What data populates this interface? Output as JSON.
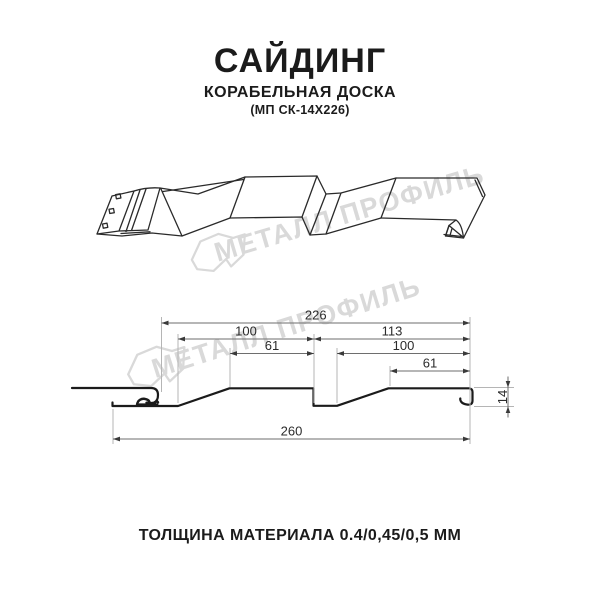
{
  "header": {
    "title": "САЙДИНГ",
    "subtitle": "КОРАБЕЛЬНАЯ ДОСКА",
    "model": "(МП СК-14Х226)"
  },
  "footer": {
    "text": "ТОЛЩИНА МАТЕРИАЛА 0.4/0,45/0,5 ММ"
  },
  "watermark": {
    "text": "МЕТАЛЛ ПРОФИЛЬ",
    "color": "#d9d9d9"
  },
  "drawing": {
    "colors": {
      "profile": "#1b1b1b",
      "sketch": "#2a2a2a",
      "dim_line": "#6e6e6e",
      "ext_line": "#b5b5b5",
      "arrow": "#3a3a3a",
      "dim_text": "#2b2b2b"
    },
    "dimensions_mm": {
      "horizontal": [
        {
          "label": "226",
          "x1": 161.5,
          "x2": 470,
          "y": 323
        },
        {
          "label": "100",
          "x1": 178,
          "x2": 314,
          "y": 339
        },
        {
          "label": "113",
          "x1": 314,
          "x2": 470,
          "y": 339
        },
        {
          "label": "61",
          "x1": 230,
          "x2": 314,
          "y": 353.5
        },
        {
          "label": "100",
          "x1": 337,
          "x2": 470,
          "y": 353.5
        },
        {
          "label": "61",
          "x1": 390,
          "x2": 470,
          "y": 371
        },
        {
          "label": "260",
          "x1": 113,
          "x2": 470,
          "y": 439
        }
      ],
      "vertical": [
        {
          "label": "14",
          "x": 508,
          "y1": 387.5,
          "y2": 406.5
        }
      ]
    },
    "extension_lines": {
      "vertical": [
        {
          "x": 161.5,
          "y1": 317,
          "y2": 392
        },
        {
          "x": 178,
          "y1": 334,
          "y2": 403
        },
        {
          "x": 230,
          "y1": 348,
          "y2": 387
        },
        {
          "x": 314,
          "y1": 334,
          "y2": 403
        },
        {
          "x": 337,
          "y1": 348,
          "y2": 403
        },
        {
          "x": 390,
          "y1": 366,
          "y2": 386
        },
        {
          "x": 470,
          "y1": 317,
          "y2": 444
        },
        {
          "x": 113,
          "y1": 409,
          "y2": 444
        }
      ],
      "horizontal": [
        {
          "y": 387.5,
          "x1": 474,
          "x2": 514
        },
        {
          "y": 406.5,
          "x1": 474,
          "x2": 514
        }
      ]
    }
  }
}
